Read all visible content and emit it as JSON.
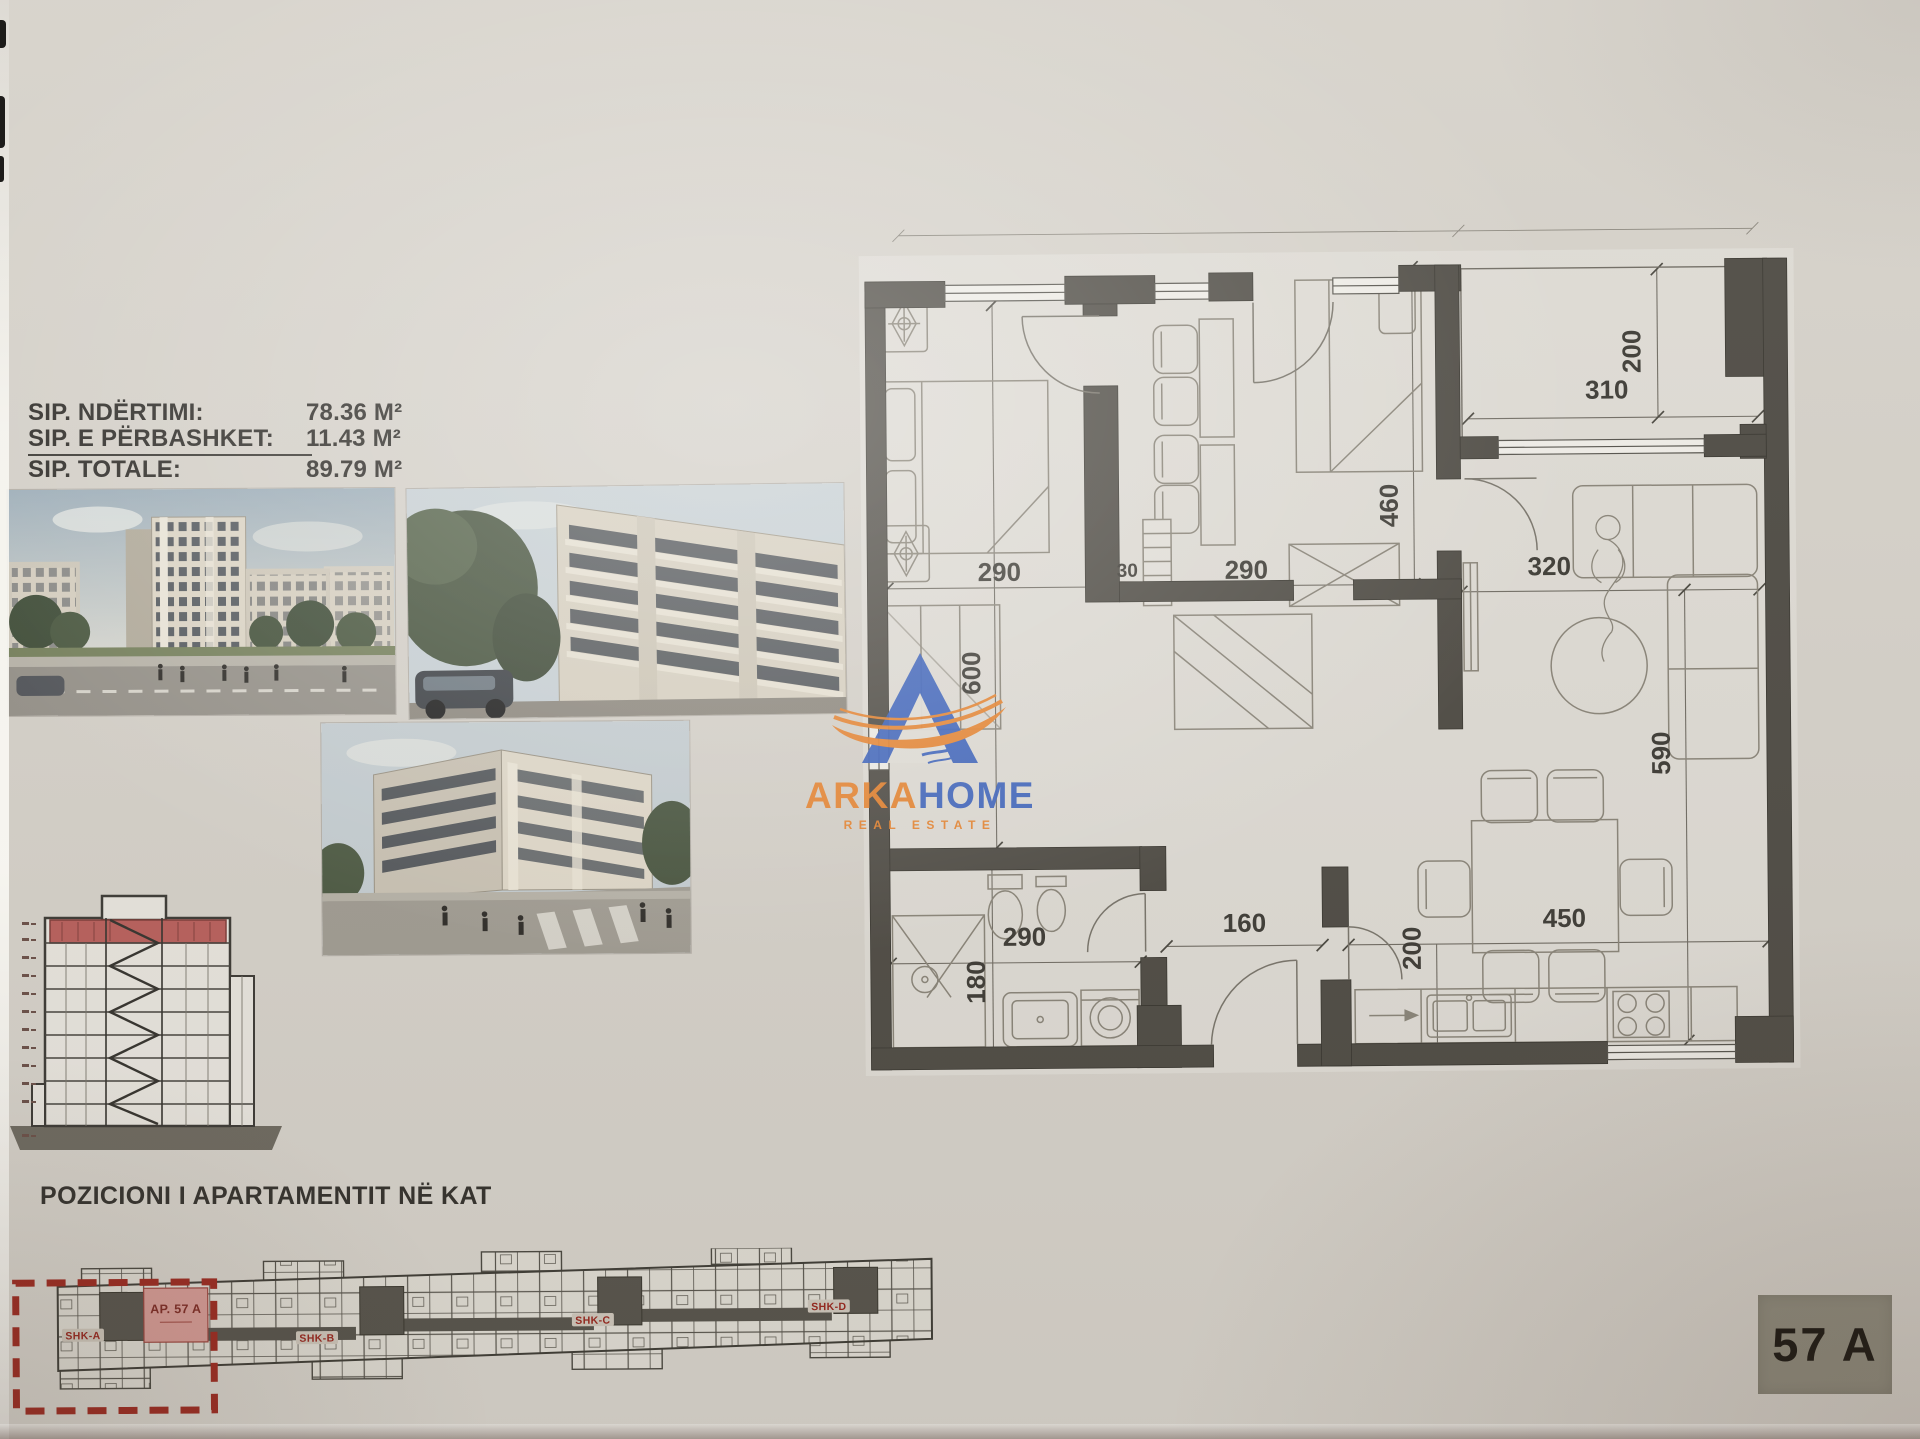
{
  "document": {
    "area_table": {
      "rows": [
        {
          "label": "SIP. NDËRTIMI:",
          "value": "78.36 M²"
        },
        {
          "label": "SIP. E PËRBASHKET:",
          "value": "11.43 M²"
        },
        {
          "label": "SIP. TOTALE:",
          "value": "89.79 M²"
        }
      ]
    },
    "logo": {
      "word_primary": "ARKA",
      "word_secondary": "HOME",
      "tagline": "REAL ESTATE",
      "colors": {
        "blue": "#3c63bd",
        "orange": "#e8842e"
      }
    },
    "plan": {
      "dims": {
        "bedroom1_width": "290",
        "partition": "30",
        "bedroom2_width": "290",
        "bedroom2_depth": "460",
        "left_wing_depth": "600",
        "terrace_width": "310",
        "terrace_depth": "200",
        "living_width": "320",
        "living_depth": "590",
        "hall_width": "160",
        "bath_width": "290",
        "bath_depth": "180",
        "kitchen_width": "450",
        "kitchen_depth": "200"
      },
      "wall_color": "#4f4c45"
    },
    "position": {
      "title": "POZICIONI I APARTAMENTIT NË KAT",
      "apartment_label": "AP. 57 A",
      "cores": [
        "SHK-A",
        "SHK-B",
        "SHK-C",
        "SHK-D"
      ],
      "highlight_color": "#9c2a20"
    },
    "badge": {
      "text": "57 A"
    }
  }
}
